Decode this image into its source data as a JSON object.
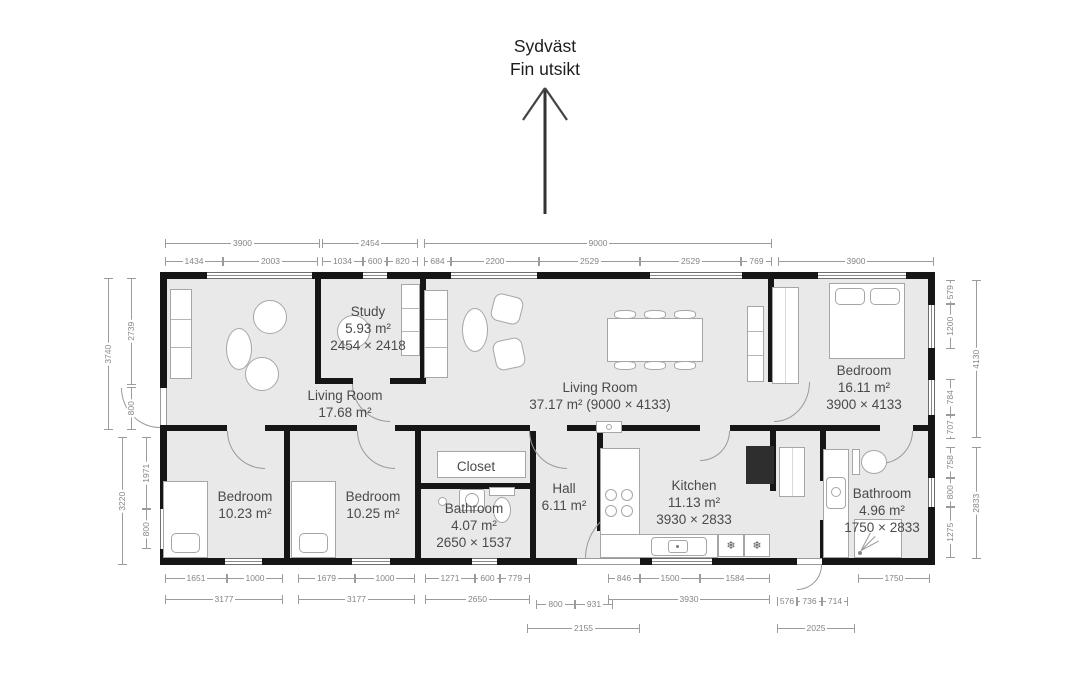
{
  "compass": {
    "direction": "Sydväst",
    "note": "Fin utsikt"
  },
  "rooms": [
    {
      "id": "study",
      "name": "Study",
      "area": "5.93 m²",
      "size": "2454 × 2418"
    },
    {
      "id": "living-left",
      "name": "Living Room",
      "area": "17.68 m²",
      "size": ""
    },
    {
      "id": "living-main",
      "name": "Living Room",
      "area": "37.17 m² (9000 × 4133)",
      "size": ""
    },
    {
      "id": "bedroom-right",
      "name": "Bedroom",
      "area": "16.11 m²",
      "size": "3900 × 4133"
    },
    {
      "id": "bedroom-1",
      "name": "Bedroom",
      "area": "10.23 m²",
      "size": ""
    },
    {
      "id": "bedroom-2",
      "name": "Bedroom",
      "area": "10.25 m²",
      "size": ""
    },
    {
      "id": "bathroom-main",
      "name": "Bathroom",
      "area": "4.07 m²",
      "size": "2650 × 1537"
    },
    {
      "id": "hall",
      "name": "Hall",
      "area": "6.11 m²",
      "size": ""
    },
    {
      "id": "kitchen",
      "name": "Kitchen",
      "area": "11.13 m²",
      "size": "3930 × 2833"
    },
    {
      "id": "bathroom-right",
      "name": "Bathroom",
      "area": "4.96 m²",
      "size": "1750 × 2833"
    },
    {
      "id": "closet",
      "name": "Closet",
      "area": "",
      "size": ""
    }
  ],
  "icons": {
    "snowflake": "❄"
  },
  "colors": {
    "wall": "#161616",
    "floor": "#e9e9e9",
    "dimension_text": "#858585",
    "label_text": "#4a4a4a"
  },
  "dimensions": {
    "top": [
      {
        "v": "3900",
        "x": 165,
        "y": 243,
        "l": 155
      },
      {
        "v": "2454",
        "x": 322,
        "y": 243,
        "l": 96
      },
      {
        "v": "9000",
        "x": 424,
        "y": 243,
        "l": 348
      },
      {
        "v": "1434",
        "x": 165,
        "y": 261,
        "l": 58
      },
      {
        "v": "2003",
        "x": 223,
        "y": 261,
        "l": 95
      },
      {
        "v": "1034",
        "x": 322,
        "y": 261,
        "l": 41
      },
      {
        "v": "600",
        "x": 363,
        "y": 261,
        "l": 24
      },
      {
        "v": "820",
        "x": 387,
        "y": 261,
        "l": 31
      },
      {
        "v": "684",
        "x": 424,
        "y": 261,
        "l": 27
      },
      {
        "v": "2200",
        "x": 451,
        "y": 261,
        "l": 88
      },
      {
        "v": "2529",
        "x": 539,
        "y": 261,
        "l": 101
      },
      {
        "v": "2529",
        "x": 640,
        "y": 261,
        "l": 101
      },
      {
        "v": "769",
        "x": 741,
        "y": 261,
        "l": 31
      },
      {
        "v": "3900",
        "x": 778,
        "y": 261,
        "l": 156
      }
    ],
    "bottom": [
      {
        "v": "1651",
        "x": 165,
        "y": 578,
        "l": 62
      },
      {
        "v": "1000",
        "x": 227,
        "y": 578,
        "l": 56
      },
      {
        "v": "1679",
        "x": 298,
        "y": 578,
        "l": 57
      },
      {
        "v": "1000",
        "x": 355,
        "y": 578,
        "l": 60
      },
      {
        "v": "1271",
        "x": 425,
        "y": 578,
        "l": 50
      },
      {
        "v": "600",
        "x": 475,
        "y": 578,
        "l": 25
      },
      {
        "v": "779",
        "x": 500,
        "y": 578,
        "l": 30
      },
      {
        "v": "846",
        "x": 608,
        "y": 578,
        "l": 32
      },
      {
        "v": "1500",
        "x": 640,
        "y": 578,
        "l": 60
      },
      {
        "v": "1584",
        "x": 700,
        "y": 578,
        "l": 70
      },
      {
        "v": "1750",
        "x": 858,
        "y": 578,
        "l": 72
      },
      {
        "v": "3177",
        "x": 165,
        "y": 599,
        "l": 118
      },
      {
        "v": "3177",
        "x": 298,
        "y": 599,
        "l": 117
      },
      {
        "v": "2650",
        "x": 425,
        "y": 599,
        "l": 105
      },
      {
        "v": "3930",
        "x": 608,
        "y": 599,
        "l": 162
      },
      {
        "v": "800",
        "x": 536,
        "y": 604,
        "l": 39
      },
      {
        "v": "931",
        "x": 575,
        "y": 604,
        "l": 38
      },
      {
        "v": "576",
        "x": 777,
        "y": 601,
        "l": 20
      },
      {
        "v": "736",
        "x": 797,
        "y": 601,
        "l": 25
      },
      {
        "v": "714",
        "x": 822,
        "y": 601,
        "l": 26
      },
      {
        "v": "2155",
        "x": 527,
        "y": 628,
        "l": 113
      },
      {
        "v": "2025",
        "x": 777,
        "y": 628,
        "l": 78
      }
    ],
    "left": [
      {
        "v": "3740",
        "x": 108,
        "y": 278,
        "l": 152
      },
      {
        "v": "2739",
        "x": 131,
        "y": 278,
        "l": 107
      },
      {
        "v": "800",
        "x": 131,
        "y": 387,
        "l": 43
      },
      {
        "v": "3220",
        "x": 122,
        "y": 437,
        "l": 128
      },
      {
        "v": "1971",
        "x": 146,
        "y": 437,
        "l": 72
      },
      {
        "v": "800",
        "x": 146,
        "y": 509,
        "l": 40
      }
    ],
    "right": [
      {
        "v": "579",
        "x": 950,
        "y": 280,
        "l": 24
      },
      {
        "v": "1200",
        "x": 950,
        "y": 304,
        "l": 45
      },
      {
        "v": "784",
        "x": 950,
        "y": 379,
        "l": 36
      },
      {
        "v": "707",
        "x": 950,
        "y": 415,
        "l": 24
      },
      {
        "v": "4130",
        "x": 976,
        "y": 280,
        "l": 158
      },
      {
        "v": "758",
        "x": 950,
        "y": 447,
        "l": 31
      },
      {
        "v": "800",
        "x": 950,
        "y": 478,
        "l": 29
      },
      {
        "v": "1275",
        "x": 950,
        "y": 507,
        "l": 51
      },
      {
        "v": "2833",
        "x": 976,
        "y": 447,
        "l": 112
      }
    ]
  }
}
